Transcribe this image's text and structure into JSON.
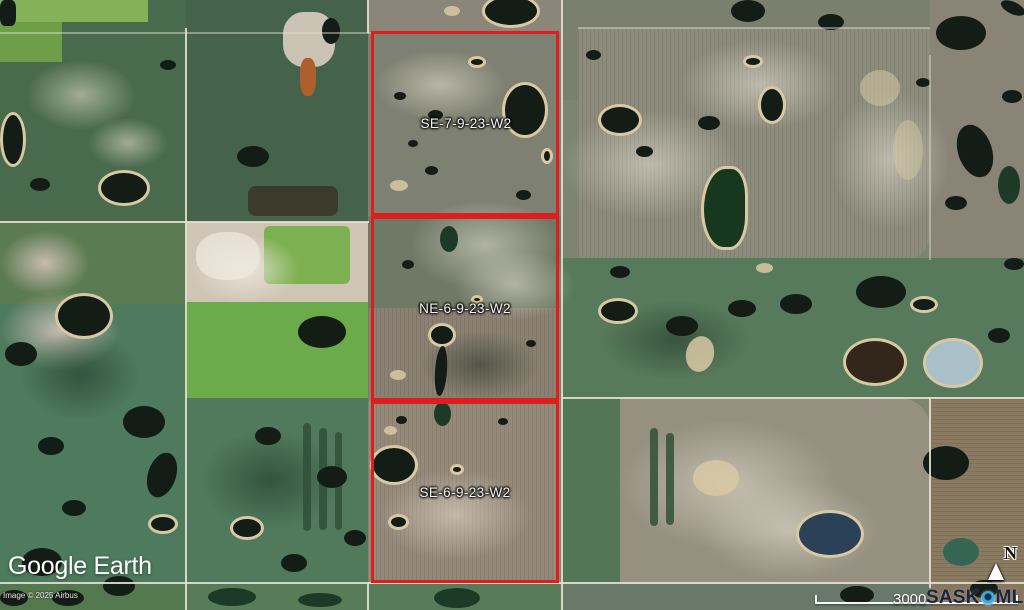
{
  "map": {
    "parcels": [
      {
        "label": "SE-7-9-23-W2"
      },
      {
        "label": "NE-6-9-23-W2"
      },
      {
        "label": "SE-6-9-23-W2"
      }
    ],
    "outline_color": "#e01d1d"
  },
  "branding": {
    "google_earth": "Google Earth",
    "attribution": "Image © 2025 Airbus"
  },
  "scale_bar": {
    "distance": "3000"
  },
  "compass": {
    "north": "N"
  },
  "sask_mls": {
    "sask": "SASK",
    "mls": "MLS",
    "registered": "®",
    "pin_color": "#3fa9de",
    "text_color": "#1a2540"
  }
}
